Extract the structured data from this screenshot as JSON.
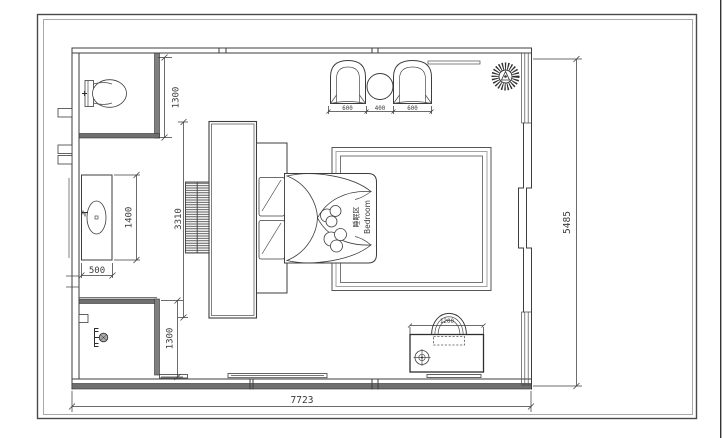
{
  "page": {
    "background": "#ffffff",
    "frame_color_outer": "#4a4a4a",
    "frame_color_inner": "#a8a8a8",
    "line_color": "#3d3d3d",
    "wall_fill": "#6f6f6f"
  },
  "plan": {
    "room_label": {
      "zh": "睡眠区",
      "en": "Bedroom"
    },
    "dims": {
      "overall_width": "7723",
      "overall_height": "5485",
      "wc_depth": "1300",
      "shower_depth": "1300",
      "vanity_length": "1400",
      "vanity_depth": "500",
      "tv_wall_length": "3310",
      "armchair_left_width": "600",
      "side_table_width": "400",
      "armchair_right_width": "600",
      "desk_width": "1200"
    }
  }
}
